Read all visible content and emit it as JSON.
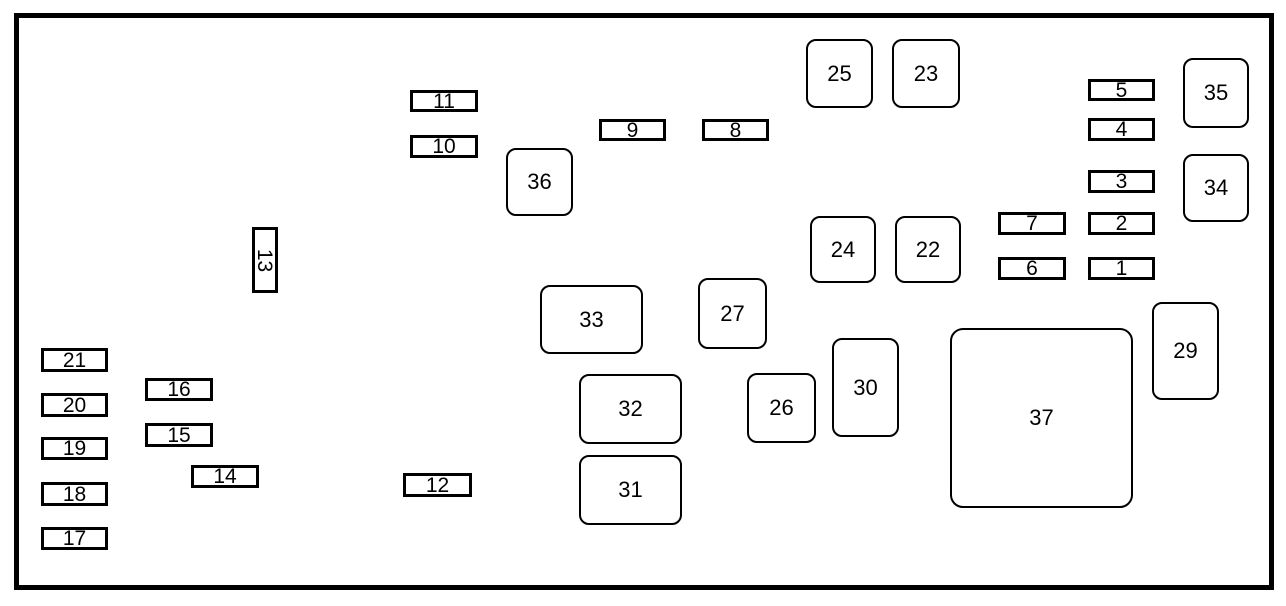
{
  "diagram": {
    "kind": "fuse-block-diagram",
    "colors": {
      "line": "#000000",
      "background": "#ffffff",
      "text": "#000000"
    },
    "frame": {
      "x": 14,
      "y": 13,
      "width": 1260,
      "height": 577,
      "border_px": 5
    },
    "slots": [
      {
        "label": "1",
        "x": 1088,
        "y": 257,
        "w": 67,
        "h": 23,
        "shape": "rect"
      },
      {
        "label": "2",
        "x": 1088,
        "y": 212,
        "w": 67,
        "h": 23,
        "shape": "rect"
      },
      {
        "label": "3",
        "x": 1088,
        "y": 170,
        "w": 67,
        "h": 23,
        "shape": "rect"
      },
      {
        "label": "4",
        "x": 1088,
        "y": 118,
        "w": 67,
        "h": 23,
        "shape": "rect"
      },
      {
        "label": "5",
        "x": 1088,
        "y": 79,
        "w": 67,
        "h": 22,
        "shape": "rect"
      },
      {
        "label": "6",
        "x": 998,
        "y": 257,
        "w": 68,
        "h": 23,
        "shape": "rect"
      },
      {
        "label": "7",
        "x": 998,
        "y": 212,
        "w": 68,
        "h": 23,
        "shape": "rect"
      },
      {
        "label": "8",
        "x": 702,
        "y": 119,
        "w": 67,
        "h": 22,
        "shape": "rect"
      },
      {
        "label": "9",
        "x": 599,
        "y": 119,
        "w": 67,
        "h": 22,
        "shape": "rect"
      },
      {
        "label": "10",
        "x": 410,
        "y": 135,
        "w": 68,
        "h": 23,
        "shape": "rect"
      },
      {
        "label": "11",
        "x": 410,
        "y": 90,
        "w": 68,
        "h": 22,
        "shape": "rect"
      },
      {
        "label": "12",
        "x": 403,
        "y": 473,
        "w": 69,
        "h": 24,
        "shape": "rect"
      },
      {
        "label": "13",
        "x": 252,
        "y": 227,
        "w": 26,
        "h": 66,
        "shape": "rect-vertical"
      },
      {
        "label": "14",
        "x": 191,
        "y": 465,
        "w": 68,
        "h": 23,
        "shape": "rect"
      },
      {
        "label": "15",
        "x": 145,
        "y": 423,
        "w": 68,
        "h": 24,
        "shape": "rect"
      },
      {
        "label": "16",
        "x": 145,
        "y": 378,
        "w": 68,
        "h": 23,
        "shape": "rect"
      },
      {
        "label": "17",
        "x": 41,
        "y": 527,
        "w": 67,
        "h": 23,
        "shape": "rect"
      },
      {
        "label": "18",
        "x": 41,
        "y": 482,
        "w": 67,
        "h": 24,
        "shape": "rect"
      },
      {
        "label": "19",
        "x": 41,
        "y": 437,
        "w": 67,
        "h": 23,
        "shape": "rect"
      },
      {
        "label": "20",
        "x": 41,
        "y": 393,
        "w": 67,
        "h": 24,
        "shape": "rect"
      },
      {
        "label": "21",
        "x": 41,
        "y": 348,
        "w": 67,
        "h": 24,
        "shape": "rect"
      },
      {
        "label": "22",
        "x": 895,
        "y": 216,
        "w": 66,
        "h": 67,
        "shape": "rounded"
      },
      {
        "label": "23",
        "x": 892,
        "y": 39,
        "w": 68,
        "h": 69,
        "shape": "rounded"
      },
      {
        "label": "24",
        "x": 810,
        "y": 216,
        "w": 66,
        "h": 67,
        "shape": "rounded"
      },
      {
        "label": "25",
        "x": 806,
        "y": 39,
        "w": 67,
        "h": 69,
        "shape": "rounded"
      },
      {
        "label": "26",
        "x": 747,
        "y": 373,
        "w": 69,
        "h": 70,
        "shape": "rounded"
      },
      {
        "label": "27",
        "x": 698,
        "y": 278,
        "w": 69,
        "h": 71,
        "shape": "rounded"
      },
      {
        "label": "29",
        "x": 1152,
        "y": 302,
        "w": 67,
        "h": 98,
        "shape": "rounded"
      },
      {
        "label": "30",
        "x": 832,
        "y": 338,
        "w": 67,
        "h": 99,
        "shape": "rounded"
      },
      {
        "label": "31",
        "x": 579,
        "y": 455,
        "w": 103,
        "h": 70,
        "shape": "rounded"
      },
      {
        "label": "32",
        "x": 579,
        "y": 374,
        "w": 103,
        "h": 70,
        "shape": "rounded"
      },
      {
        "label": "33",
        "x": 540,
        "y": 285,
        "w": 103,
        "h": 69,
        "shape": "rounded"
      },
      {
        "label": "34",
        "x": 1183,
        "y": 154,
        "w": 66,
        "h": 68,
        "shape": "rounded"
      },
      {
        "label": "35",
        "x": 1183,
        "y": 58,
        "w": 66,
        "h": 70,
        "shape": "rounded"
      },
      {
        "label": "36",
        "x": 506,
        "y": 148,
        "w": 67,
        "h": 68,
        "shape": "rounded"
      },
      {
        "label": "37",
        "x": 950,
        "y": 328,
        "w": 183,
        "h": 180,
        "shape": "rounded-large"
      }
    ]
  }
}
